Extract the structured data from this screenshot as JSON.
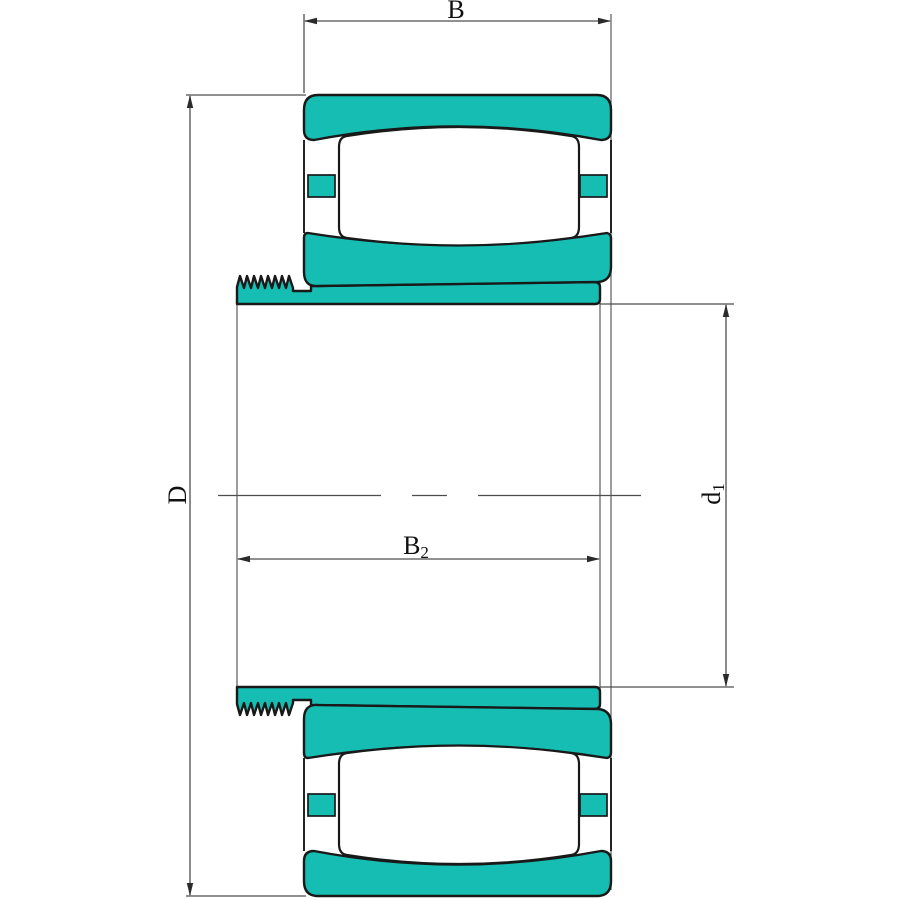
{
  "drawing": {
    "title": "bearing-with-adapter-sleeve-cross-section",
    "dimensions": {
      "bearing_width": {
        "label": "B"
      },
      "outer_diameter": {
        "label": "D"
      },
      "sleeve_width": {
        "label_main": "B",
        "label_sub": "2"
      },
      "bore_diameter": {
        "label_main": "d",
        "label_sub": "1"
      }
    },
    "colors": {
      "part_fill": "#16bdb2",
      "outline": "#191919",
      "dimension_line": "#4d4d4d",
      "background": "#ffffff",
      "label_color": "#111111"
    }
  }
}
